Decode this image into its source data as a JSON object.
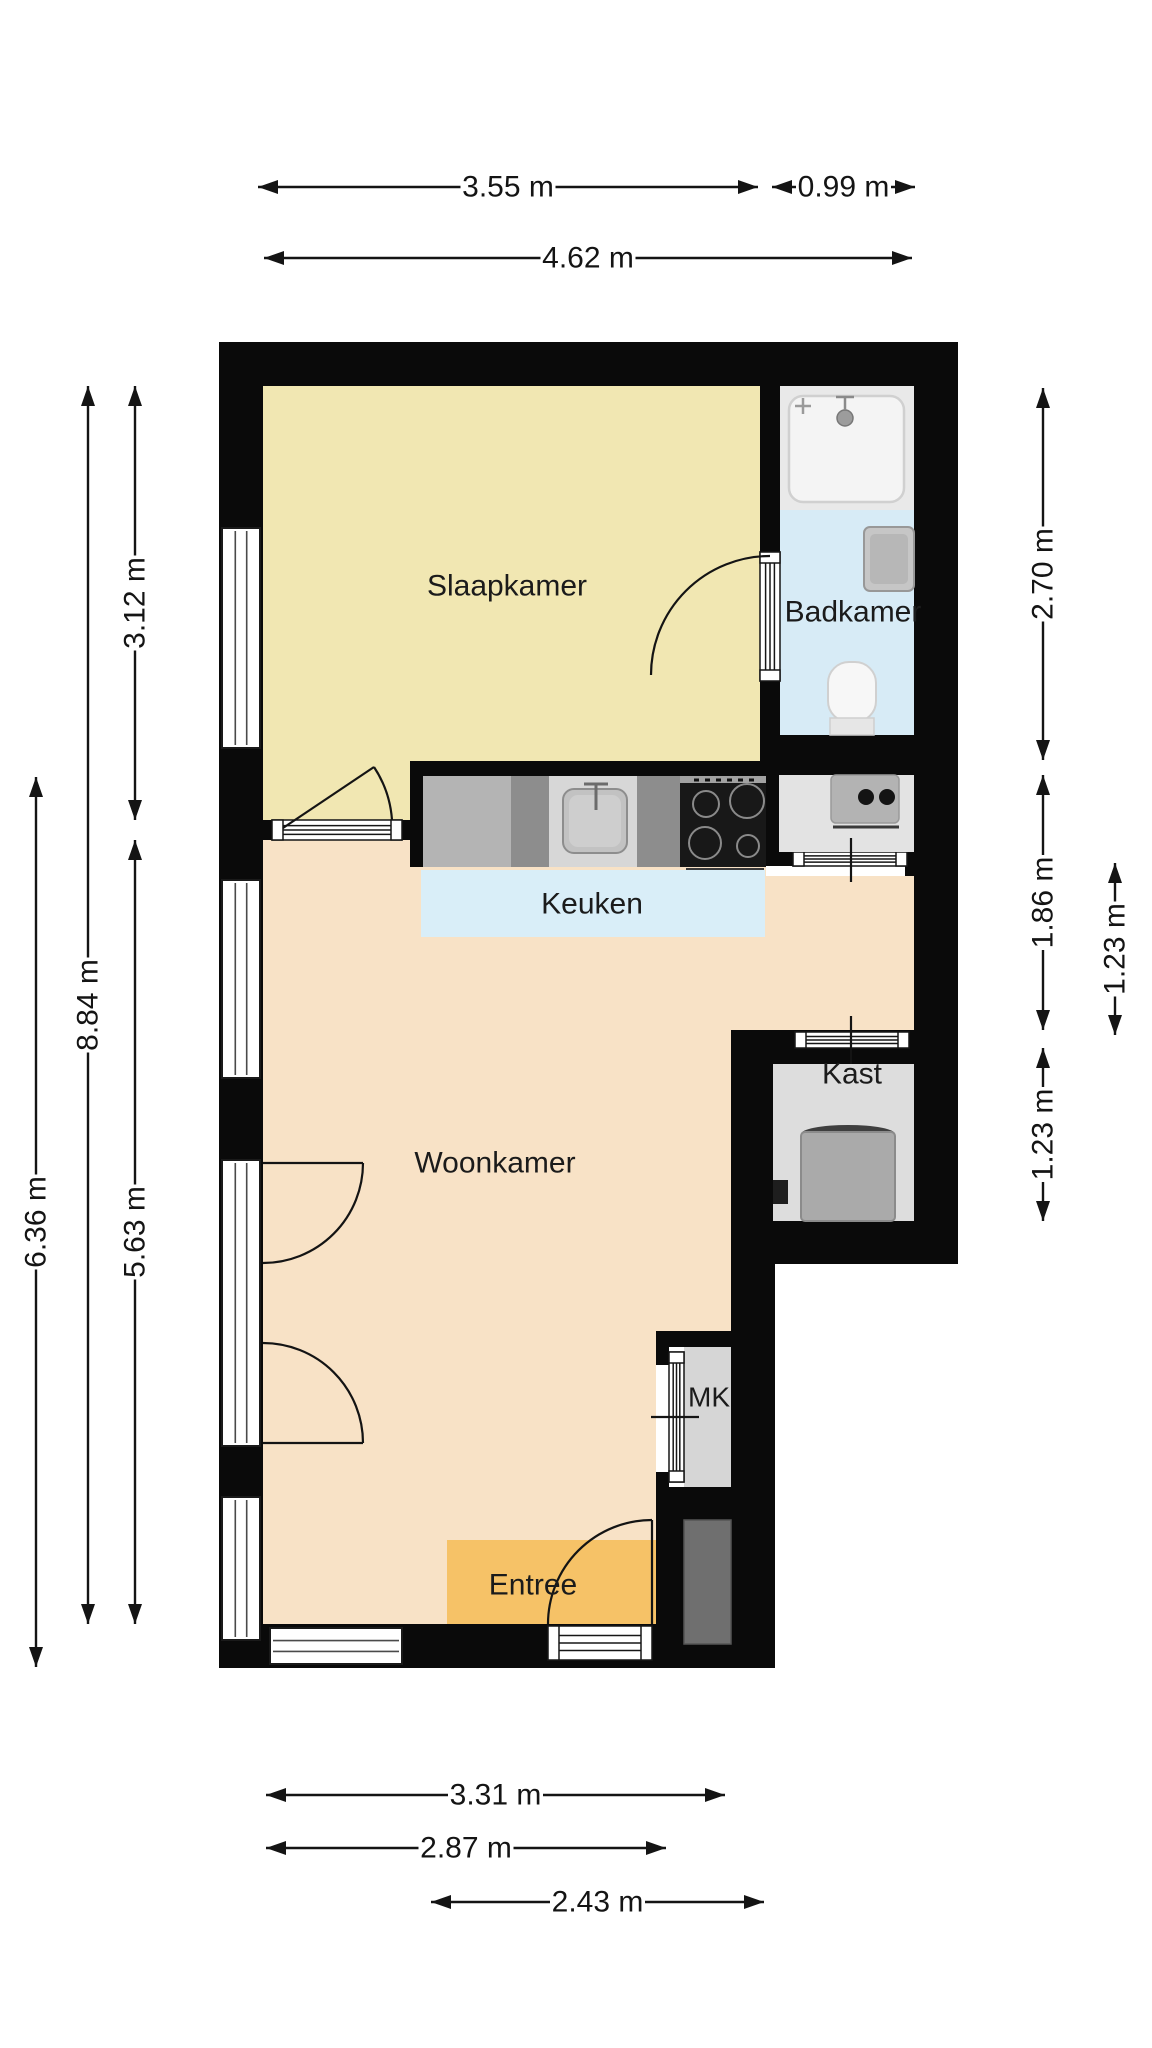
{
  "floor_plan": {
    "canvas": {
      "width": 1152,
      "height": 2048,
      "background": "#ffffff"
    },
    "style": {
      "wall_color": "#0a0a0a",
      "line_color": "#141414",
      "label_color": "#1b1b1b",
      "dim_font_size": 30,
      "window_fill": "#ffffff",
      "door_fill": "#ffffff"
    },
    "rooms": [
      {
        "name": "slaapkamer",
        "label": "Slaapkamer",
        "color": "#f1e7b2",
        "label_x": 507,
        "label_y": 586,
        "font_size": 30,
        "points": "263,386 760,386 760,761 410,761 410,820 263,820"
      },
      {
        "name": "badkamer",
        "label": "Badkamer",
        "color": "#d7ebf6",
        "label_x": 853,
        "label_y": 612,
        "font_size": 30,
        "points": "780,386 914,386 914,735 780,735"
      },
      {
        "name": "woonkamer",
        "label": "Woonkamer",
        "color": "#f8e2c6",
        "label_x": 495,
        "label_y": 1163,
        "font_size": 30,
        "points": "263,840 766,840 766,876 914,876 914,1030 731,1030 731,1331 656,1331 656,1624 263,1624"
      },
      {
        "name": "keuken",
        "label": "Keuken",
        "color": "#d9eef8",
        "label_x": 592,
        "label_y": 904,
        "font_size": 30,
        "points": "421,870 765,870 765,937 421,937"
      },
      {
        "name": "kast",
        "label": "Kast",
        "color": "#dddddd",
        "label_x": 852,
        "label_y": 1074,
        "font_size": 30,
        "points": "773,1064 914,1064 914,1221 773,1221"
      },
      {
        "name": "mk",
        "label": "MK",
        "color": "#d6d6d6",
        "label_x": 709,
        "label_y": 1397,
        "font_size": 28,
        "points": "684,1347 731,1347 731,1487 684,1487"
      },
      {
        "name": "entree",
        "label": "Entree",
        "color": "#f6c267",
        "label_x": 533,
        "label_y": 1585,
        "font_size": 30,
        "points": "447,1540 657,1540 657,1624 447,1624"
      }
    ],
    "walls": [
      [
        "wall-top",
        219,
        342,
        739,
        44
      ],
      [
        "wall-left",
        219,
        342,
        44,
        1326
      ],
      [
        "wall-right-upper",
        914,
        342,
        44,
        922
      ],
      [
        "wall-bottom",
        219,
        1624,
        556,
        44
      ],
      [
        "wall-right-lower",
        731,
        1264,
        44,
        404
      ],
      [
        "wall-bedroom-bathroom",
        760,
        386,
        20,
        376
      ],
      [
        "wall-bathroom-bottom",
        760,
        735,
        154,
        40
      ],
      [
        "wall-bedroom-living",
        263,
        820,
        147,
        20
      ],
      [
        "wall-kitchen-top",
        410,
        761,
        380,
        15
      ],
      [
        "wall-counter-left",
        410,
        761,
        13,
        106
      ],
      [
        "wall-counter-right",
        766,
        735,
        27,
        131
      ],
      [
        "wall-nook-door-right",
        905,
        852,
        9,
        24
      ],
      [
        "wall-kast-top",
        731,
        1030,
        183,
        34
      ],
      [
        "wall-kast-left",
        731,
        1064,
        42,
        200
      ],
      [
        "wall-kast-bottom",
        731,
        1221,
        227,
        43
      ],
      [
        "wall-mk-top",
        656,
        1331,
        75,
        16
      ],
      [
        "wall-mk-left-top",
        656,
        1331,
        13,
        34
      ],
      [
        "wall-mk-left-bottom",
        656,
        1472,
        13,
        48
      ],
      [
        "wall-mk-bottom",
        656,
        1487,
        75,
        33
      ],
      [
        "wall-shaft-left",
        656,
        1520,
        28,
        104
      ]
    ],
    "windows": [
      {
        "name": "window-left-1",
        "x": 222,
        "y": 528,
        "w": 38,
        "h": 220,
        "orient": "v"
      },
      {
        "name": "window-left-2",
        "x": 222,
        "y": 880,
        "w": 38,
        "h": 198,
        "orient": "v"
      },
      {
        "name": "balcony-door-opening",
        "x": 222,
        "y": 1160,
        "w": 38,
        "h": 286,
        "orient": "v"
      },
      {
        "name": "window-left-3",
        "x": 222,
        "y": 1497,
        "w": 38,
        "h": 143,
        "orient": "v"
      },
      {
        "name": "window-bottom",
        "x": 270,
        "y": 1628,
        "w": 132,
        "h": 36,
        "orient": "h"
      }
    ],
    "doors": [
      {
        "name": "door-bedroom-threshold",
        "x": 272,
        "y": 820,
        "w": 130,
        "h": 20,
        "orient": "h"
      },
      {
        "name": "door-bathroom-threshold",
        "x": 760,
        "y": 552,
        "w": 20,
        "h": 129,
        "orient": "v"
      },
      {
        "name": "door-nook-threshold",
        "x": 793,
        "y": 852,
        "w": 114,
        "h": 14,
        "orient": "h"
      },
      {
        "name": "door-kast-threshold",
        "x": 795,
        "y": 1032,
        "w": 114,
        "h": 16,
        "orient": "h"
      },
      {
        "name": "door-mk-threshold",
        "x": 669,
        "y": 1352,
        "w": 15,
        "h": 130,
        "orient": "v"
      },
      {
        "name": "door-entry-threshold",
        "x": 548,
        "y": 1626,
        "w": 104,
        "h": 34,
        "orient": "h"
      }
    ],
    "swing_lines": [
      {
        "name": "bedroom-door-leaf",
        "d": "M 283 828 L 374 767"
      },
      {
        "name": "bedroom-door-arc",
        "d": "M 374 767 A 110 110 0 0 1 392 820"
      },
      {
        "name": "bathroom-door-arc",
        "d": "M 770 556 A 119 119 0 0 0 651 675"
      },
      {
        "name": "balcony-door-top-leaf",
        "d": "M 263 1163 L 363 1163"
      },
      {
        "name": "balcony-door-top-arc",
        "d": "M 363 1163 A 100 100 0 0 1 263 1263"
      },
      {
        "name": "balcony-door-bottom-leaf",
        "d": "M 263 1443 L 363 1443"
      },
      {
        "name": "balcony-door-bottom-arc",
        "d": "M 363 1443 A 100 100 0 0 0 263 1343"
      },
      {
        "name": "entry-door-arc",
        "d": "M 548 1624 A 104 104 0 0 1 652 1520"
      },
      {
        "name": "entry-door-leaf",
        "d": "M 652 1520 L 652 1624"
      },
      {
        "name": "kast-door-tick",
        "d": "M 851 1016 L 851 1064"
      },
      {
        "name": "nook-door-tick",
        "d": "M 851 838 L 851 882"
      },
      {
        "name": "mk-door-tick",
        "d": "M 651 1417 L 699 1417"
      }
    ],
    "fixtures": [
      {
        "name": "shower-area",
        "el": "rect",
        "attrs": {
          "x": 780,
          "y": 386,
          "width": 134,
          "height": 124,
          "fill": "#e9e9e9"
        }
      },
      {
        "name": "shower-tray",
        "el": "rect",
        "attrs": {
          "x": 789,
          "y": 396,
          "width": 115,
          "height": 106,
          "rx": 14,
          "fill": "#f4f4f4",
          "stroke": "#d0d0d0",
          "stroke-width": 2.5
        }
      },
      {
        "name": "shower-head-icon",
        "el": "circle",
        "attrs": {
          "cx": 845,
          "cy": 418,
          "r": 8,
          "fill": "#9c9c9c",
          "stroke": "#777777",
          "stroke-width": 1.5
        }
      },
      {
        "name": "shower-pipe-icon",
        "el": "path",
        "attrs": {
          "d": "M 845 410 L 845 396 M 836 397 L 854 397",
          "fill": "none",
          "stroke": "#8a8a8a",
          "stroke-width": 2.5
        }
      },
      {
        "name": "shower-tap-icon",
        "el": "path",
        "attrs": {
          "d": "M 795 406 L 811 406 M 803 398 L 803 414",
          "fill": "none",
          "stroke": "#9a9a9a",
          "stroke-width": 2.5
        }
      },
      {
        "name": "bathroom-basin",
        "el": "rect",
        "attrs": {
          "x": 864,
          "y": 527,
          "width": 50,
          "height": 64,
          "rx": 6,
          "fill": "#c6c6c6",
          "stroke": "#989898",
          "stroke-width": 2
        }
      },
      {
        "name": "bathroom-basin-inner",
        "el": "rect",
        "attrs": {
          "x": 870,
          "y": 534,
          "width": 38,
          "height": 50,
          "rx": 5,
          "fill": "#b7b7b7"
        }
      },
      {
        "name": "toilet-bowl",
        "el": "rect",
        "attrs": {
          "x": 828,
          "y": 662,
          "width": 48,
          "height": 60,
          "rx": 21,
          "fill": "#f7f7f7",
          "stroke": "#d0d0d0",
          "stroke-width": 2
        }
      },
      {
        "name": "toilet-base",
        "el": "rect",
        "attrs": {
          "x": 830,
          "y": 718,
          "width": 44,
          "height": 17,
          "fill": "#e6e6e6",
          "stroke": "#cfcfcf",
          "stroke-width": 1.5
        }
      },
      {
        "name": "nook-counter",
        "el": "rect",
        "attrs": {
          "x": 779,
          "y": 775,
          "width": 135,
          "height": 77,
          "fill": "#e3e3e3"
        }
      },
      {
        "name": "nook-basin",
        "el": "rect",
        "attrs": {
          "x": 831,
          "y": 775,
          "width": 68,
          "height": 48,
          "rx": 5,
          "fill": "#b3b3b3",
          "stroke": "#9a9a9a",
          "stroke-width": 1.5
        }
      },
      {
        "name": "nook-basin-dot-1",
        "el": "circle",
        "attrs": {
          "cx": 866,
          "cy": 797,
          "r": 8,
          "fill": "#141414"
        }
      },
      {
        "name": "nook-basin-dot-2",
        "el": "circle",
        "attrs": {
          "cx": 887,
          "cy": 797,
          "r": 8,
          "fill": "#141414"
        }
      },
      {
        "name": "nook-counter-edge",
        "el": "path",
        "attrs": {
          "d": "M 833 827 L 899 827",
          "fill": "none",
          "stroke": "#3a3a3a",
          "stroke-width": 3
        }
      },
      {
        "name": "kitchen-cabinet",
        "el": "rect",
        "attrs": {
          "x": 423,
          "y": 776,
          "width": 88,
          "height": 91,
          "fill": "#b4b4b4"
        }
      },
      {
        "name": "kitchen-cabinet-dark-1",
        "el": "rect",
        "attrs": {
          "x": 511,
          "y": 776,
          "width": 38,
          "height": 91,
          "fill": "#8d8d8d"
        }
      },
      {
        "name": "kitchen-sink-unit",
        "el": "rect",
        "attrs": {
          "x": 549,
          "y": 776,
          "width": 88,
          "height": 91,
          "fill": "#d7d7d7"
        }
      },
      {
        "name": "kitchen-sink",
        "el": "rect",
        "attrs": {
          "x": 563,
          "y": 789,
          "width": 64,
          "height": 64,
          "rx": 11,
          "fill": "#c2c2c2",
          "stroke": "#8d8d8d",
          "stroke-width": 2
        }
      },
      {
        "name": "kitchen-sink-inner",
        "el": "rect",
        "attrs": {
          "x": 569,
          "y": 795,
          "width": 52,
          "height": 52,
          "rx": 9,
          "fill": "#cecece"
        }
      },
      {
        "name": "kitchen-faucet-icon",
        "el": "path",
        "attrs": {
          "d": "M 596 784 L 596 810 M 584 784 L 608 784",
          "fill": "none",
          "stroke": "#6b6b6b",
          "stroke-width": 3
        }
      },
      {
        "name": "kitchen-cabinet-dark-2",
        "el": "rect",
        "attrs": {
          "x": 637,
          "y": 776,
          "width": 43,
          "height": 91,
          "fill": "#8d8d8d"
        }
      },
      {
        "name": "cooktop",
        "el": "rect",
        "attrs": {
          "x": 680,
          "y": 776,
          "width": 86,
          "height": 91,
          "fill": "#181818"
        }
      },
      {
        "name": "cooktop-strip",
        "el": "rect",
        "attrs": {
          "x": 680,
          "y": 776,
          "width": 86,
          "height": 7,
          "fill": "#a2a2a2"
        }
      },
      {
        "name": "cooktop-dashes",
        "el": "path",
        "attrs": {
          "d": "M 694 780 L 756 780",
          "fill": "none",
          "stroke": "#111111",
          "stroke-width": 3,
          "stroke-dasharray": "5 6"
        }
      },
      {
        "name": "burner-1",
        "el": "circle",
        "attrs": {
          "cx": 706,
          "cy": 804,
          "r": 13,
          "fill": "none",
          "stroke": "#8a8a8a",
          "stroke-width": 2
        }
      },
      {
        "name": "burner-2",
        "el": "circle",
        "attrs": {
          "cx": 747,
          "cy": 801,
          "r": 17,
          "fill": "none",
          "stroke": "#8a8a8a",
          "stroke-width": 2
        }
      },
      {
        "name": "burner-3",
        "el": "circle",
        "attrs": {
          "cx": 705,
          "cy": 843,
          "r": 16,
          "fill": "none",
          "stroke": "#8a8a8a",
          "stroke-width": 2
        }
      },
      {
        "name": "burner-4",
        "el": "circle",
        "attrs": {
          "cx": 748,
          "cy": 846,
          "r": 11,
          "fill": "none",
          "stroke": "#8a8a8a",
          "stroke-width": 2
        }
      },
      {
        "name": "counter-edge-line",
        "el": "path",
        "attrs": {
          "d": "M 686 869 L 764 869",
          "fill": "none",
          "stroke": "#3a3a3a",
          "stroke-width": 2
        }
      },
      {
        "name": "boiler-top",
        "el": "ellipse",
        "attrs": {
          "cx": 848,
          "cy": 1134,
          "rx": 47,
          "ry": 9,
          "fill": "#3f3f3f"
        }
      },
      {
        "name": "boiler",
        "el": "rect",
        "attrs": {
          "x": 801,
          "y": 1132,
          "width": 94,
          "height": 89,
          "rx": 4,
          "fill": "#aaaaaa",
          "stroke": "#8b8b8b",
          "stroke-width": 2
        }
      },
      {
        "name": "kast-duct",
        "el": "rect",
        "attrs": {
          "x": 773,
          "y": 1180,
          "width": 15,
          "height": 24,
          "fill": "#1e1e1e"
        }
      },
      {
        "name": "shaft",
        "el": "rect",
        "attrs": {
          "x": 684,
          "y": 1520,
          "width": 47,
          "height": 124,
          "fill": "#6f6f6f",
          "stroke": "#555555",
          "stroke-width": 1.5
        }
      }
    ],
    "dimensions": {
      "horizontal": [
        {
          "label": "3.55 m",
          "x1": 258,
          "x2": 758,
          "y": 187
        },
        {
          "label": "0.99 m",
          "x1": 772,
          "x2": 915,
          "y": 187
        },
        {
          "label": "4.62 m",
          "x1": 264,
          "x2": 912,
          "y": 258
        },
        {
          "label": "3.31 m",
          "x1": 266,
          "x2": 725,
          "y": 1795
        },
        {
          "label": "2.87 m",
          "x1": 266,
          "x2": 666,
          "y": 1848
        },
        {
          "label": "2.43 m",
          "x1": 431,
          "x2": 764,
          "y": 1902
        }
      ],
      "vertical": [
        {
          "label": "6.36 m",
          "x": 36,
          "y1": 777,
          "y2": 1667
        },
        {
          "label": "8.84 m",
          "x": 88,
          "y1": 386,
          "y2": 1624
        },
        {
          "label": "3.12 m",
          "x": 135,
          "y1": 386,
          "y2": 820
        },
        {
          "label": "5.63 m",
          "x": 135,
          "y1": 840,
          "y2": 1624
        },
        {
          "label": "2.70 m",
          "x": 1043,
          "y1": 388,
          "y2": 760
        },
        {
          "label": "1.86 m",
          "x": 1043,
          "y1": 775,
          "y2": 1030
        },
        {
          "label": "1.23 m",
          "x": 1043,
          "y1": 1048,
          "y2": 1221
        },
        {
          "label": "1.23 m",
          "x": 1115,
          "y1": 863,
          "y2": 1035
        }
      ]
    }
  }
}
